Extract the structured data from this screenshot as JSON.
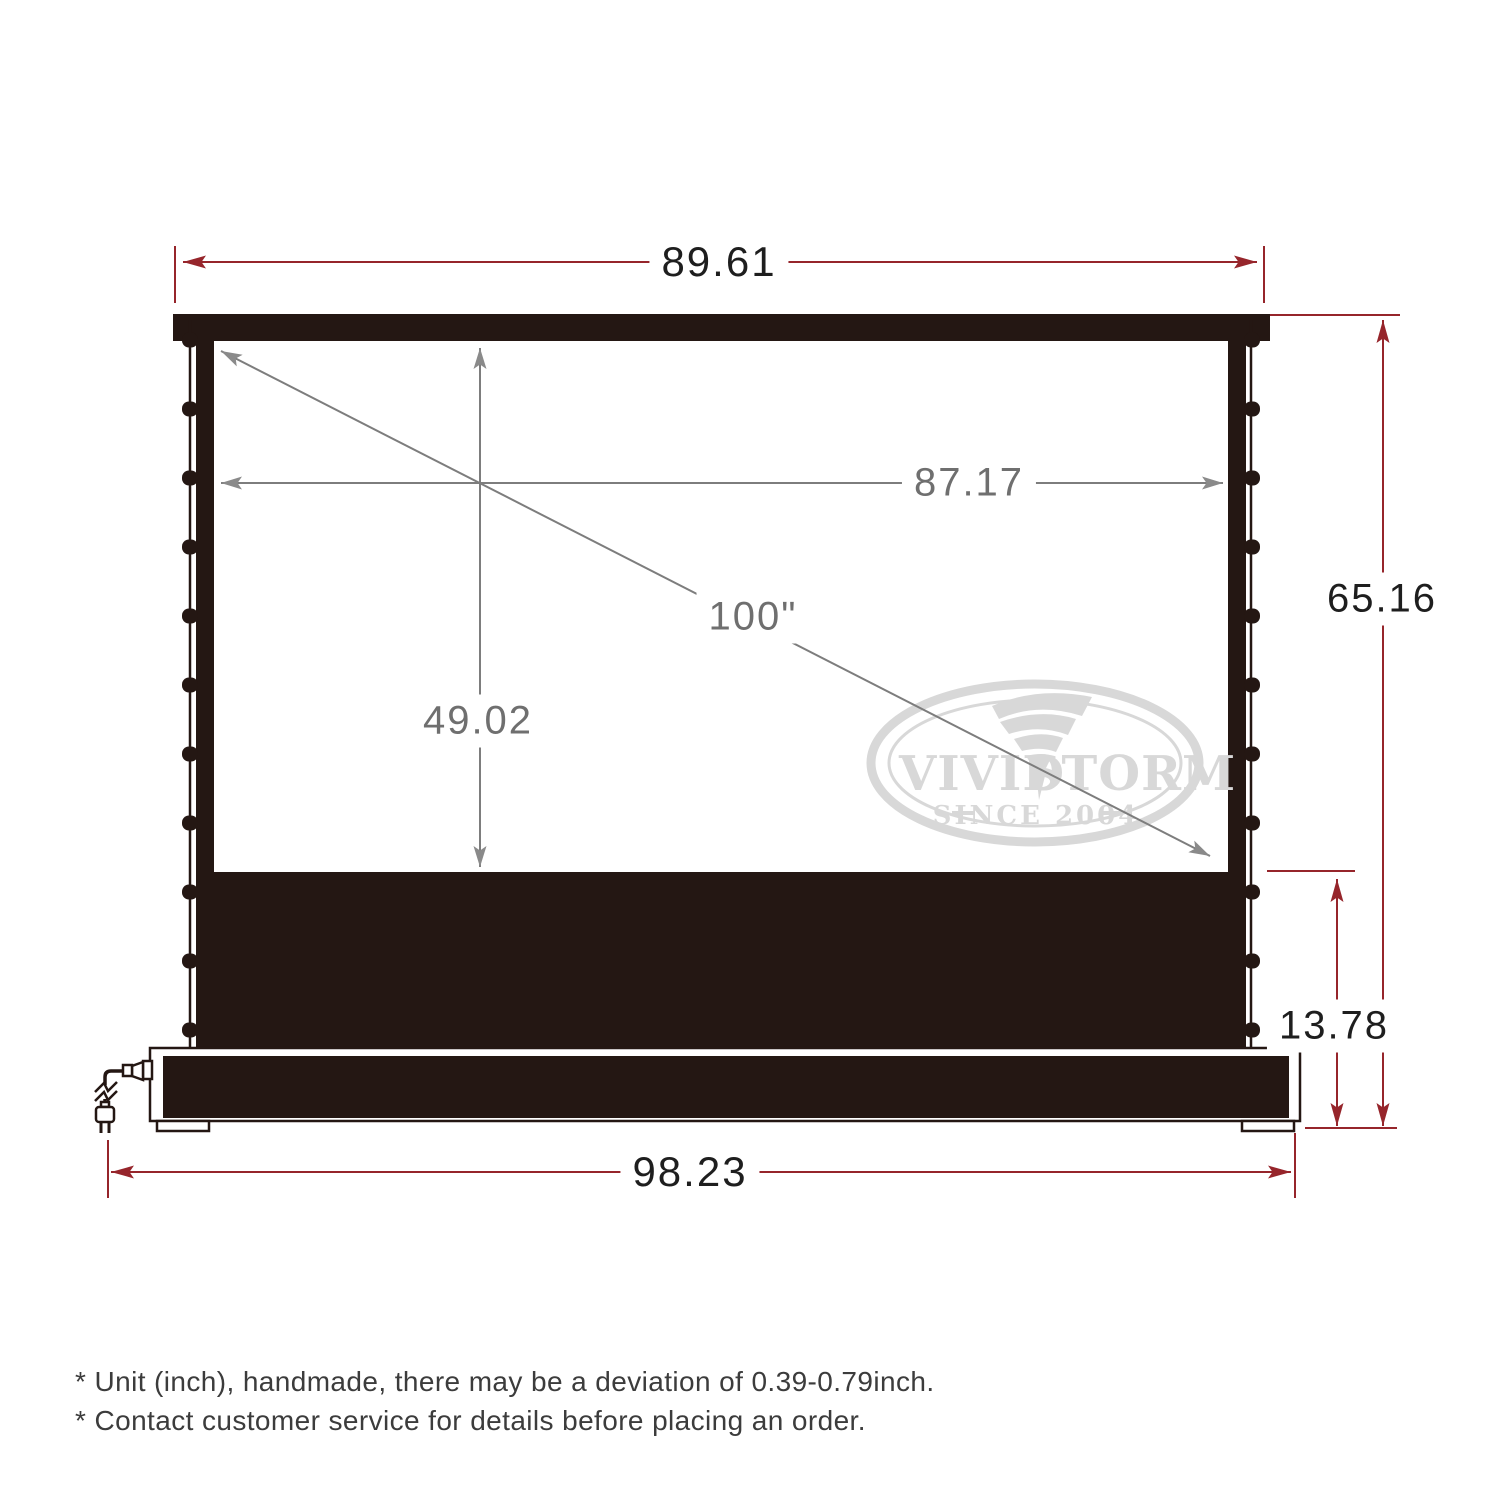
{
  "product_diagram": {
    "dimensions": {
      "top_width": "89.61",
      "viewable_width": "87.17",
      "diagonal": "100\"",
      "viewable_height": "49.02",
      "overall_height": "65.16",
      "base_height": "13.78",
      "base_width": "98.23"
    },
    "watermark": {
      "brand_word_1": "VIVID",
      "brand_word_2": "STORM",
      "tagline": "SINCE 2004"
    },
    "footnotes": [
      "* Unit (inch), handmade, there may be a deviation of 0.39-0.79inch.",
      "* Contact customer service for details before placing an order."
    ],
    "colors": {
      "dimension_red": "#96252b",
      "dimension_gray": "#6f6f6f",
      "frame_dark": "#241713",
      "watermark_gray": "#d8d8d8"
    }
  }
}
